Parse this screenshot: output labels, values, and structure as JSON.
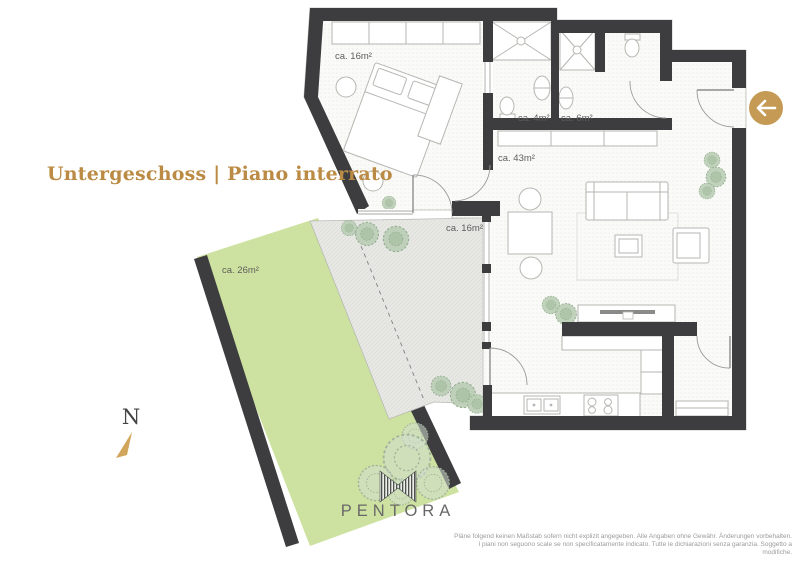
{
  "header": {
    "title": "Untergeschoss | Piano interrato"
  },
  "toolbar": {
    "back_icon": "left-arrow"
  },
  "compass": {
    "north_label": "N"
  },
  "brand": {
    "wordmark": "PENTORA"
  },
  "rooms": {
    "bedroom": {
      "area_label": "ca. 16m²"
    },
    "bathroom_small": {
      "area_label": "ca. 4m²"
    },
    "bathroom_large": {
      "area_label": "ca. 6m²"
    },
    "living": {
      "area_label": "ca. 43m²"
    },
    "terrace": {
      "area_label": "ca. 16m²"
    },
    "garden": {
      "area_label": "ca. 26m²"
    }
  },
  "footer": {
    "disclaimer_line1": "Pläne folgend keinen Maßstab sofern nicht explizit angegeben. Alle Angaben ohne Gewähr. Änderungen vorbehalten.",
    "disclaimer_line2": "I piani non seguono scale se non specificatamente indicato. Tutte le dichiarazioni senza garanzia. Soggetto a modifiche."
  },
  "colors": {
    "accent_gold": "#c49a55",
    "title_gold": "#bb8b45",
    "wall_dark": "#3d3d3f",
    "garden_green": "#cde2a0",
    "terrace_gray": "#e6e6e3",
    "plant_green": "#b9cdb4",
    "compass_needle": "#d2a55c"
  }
}
